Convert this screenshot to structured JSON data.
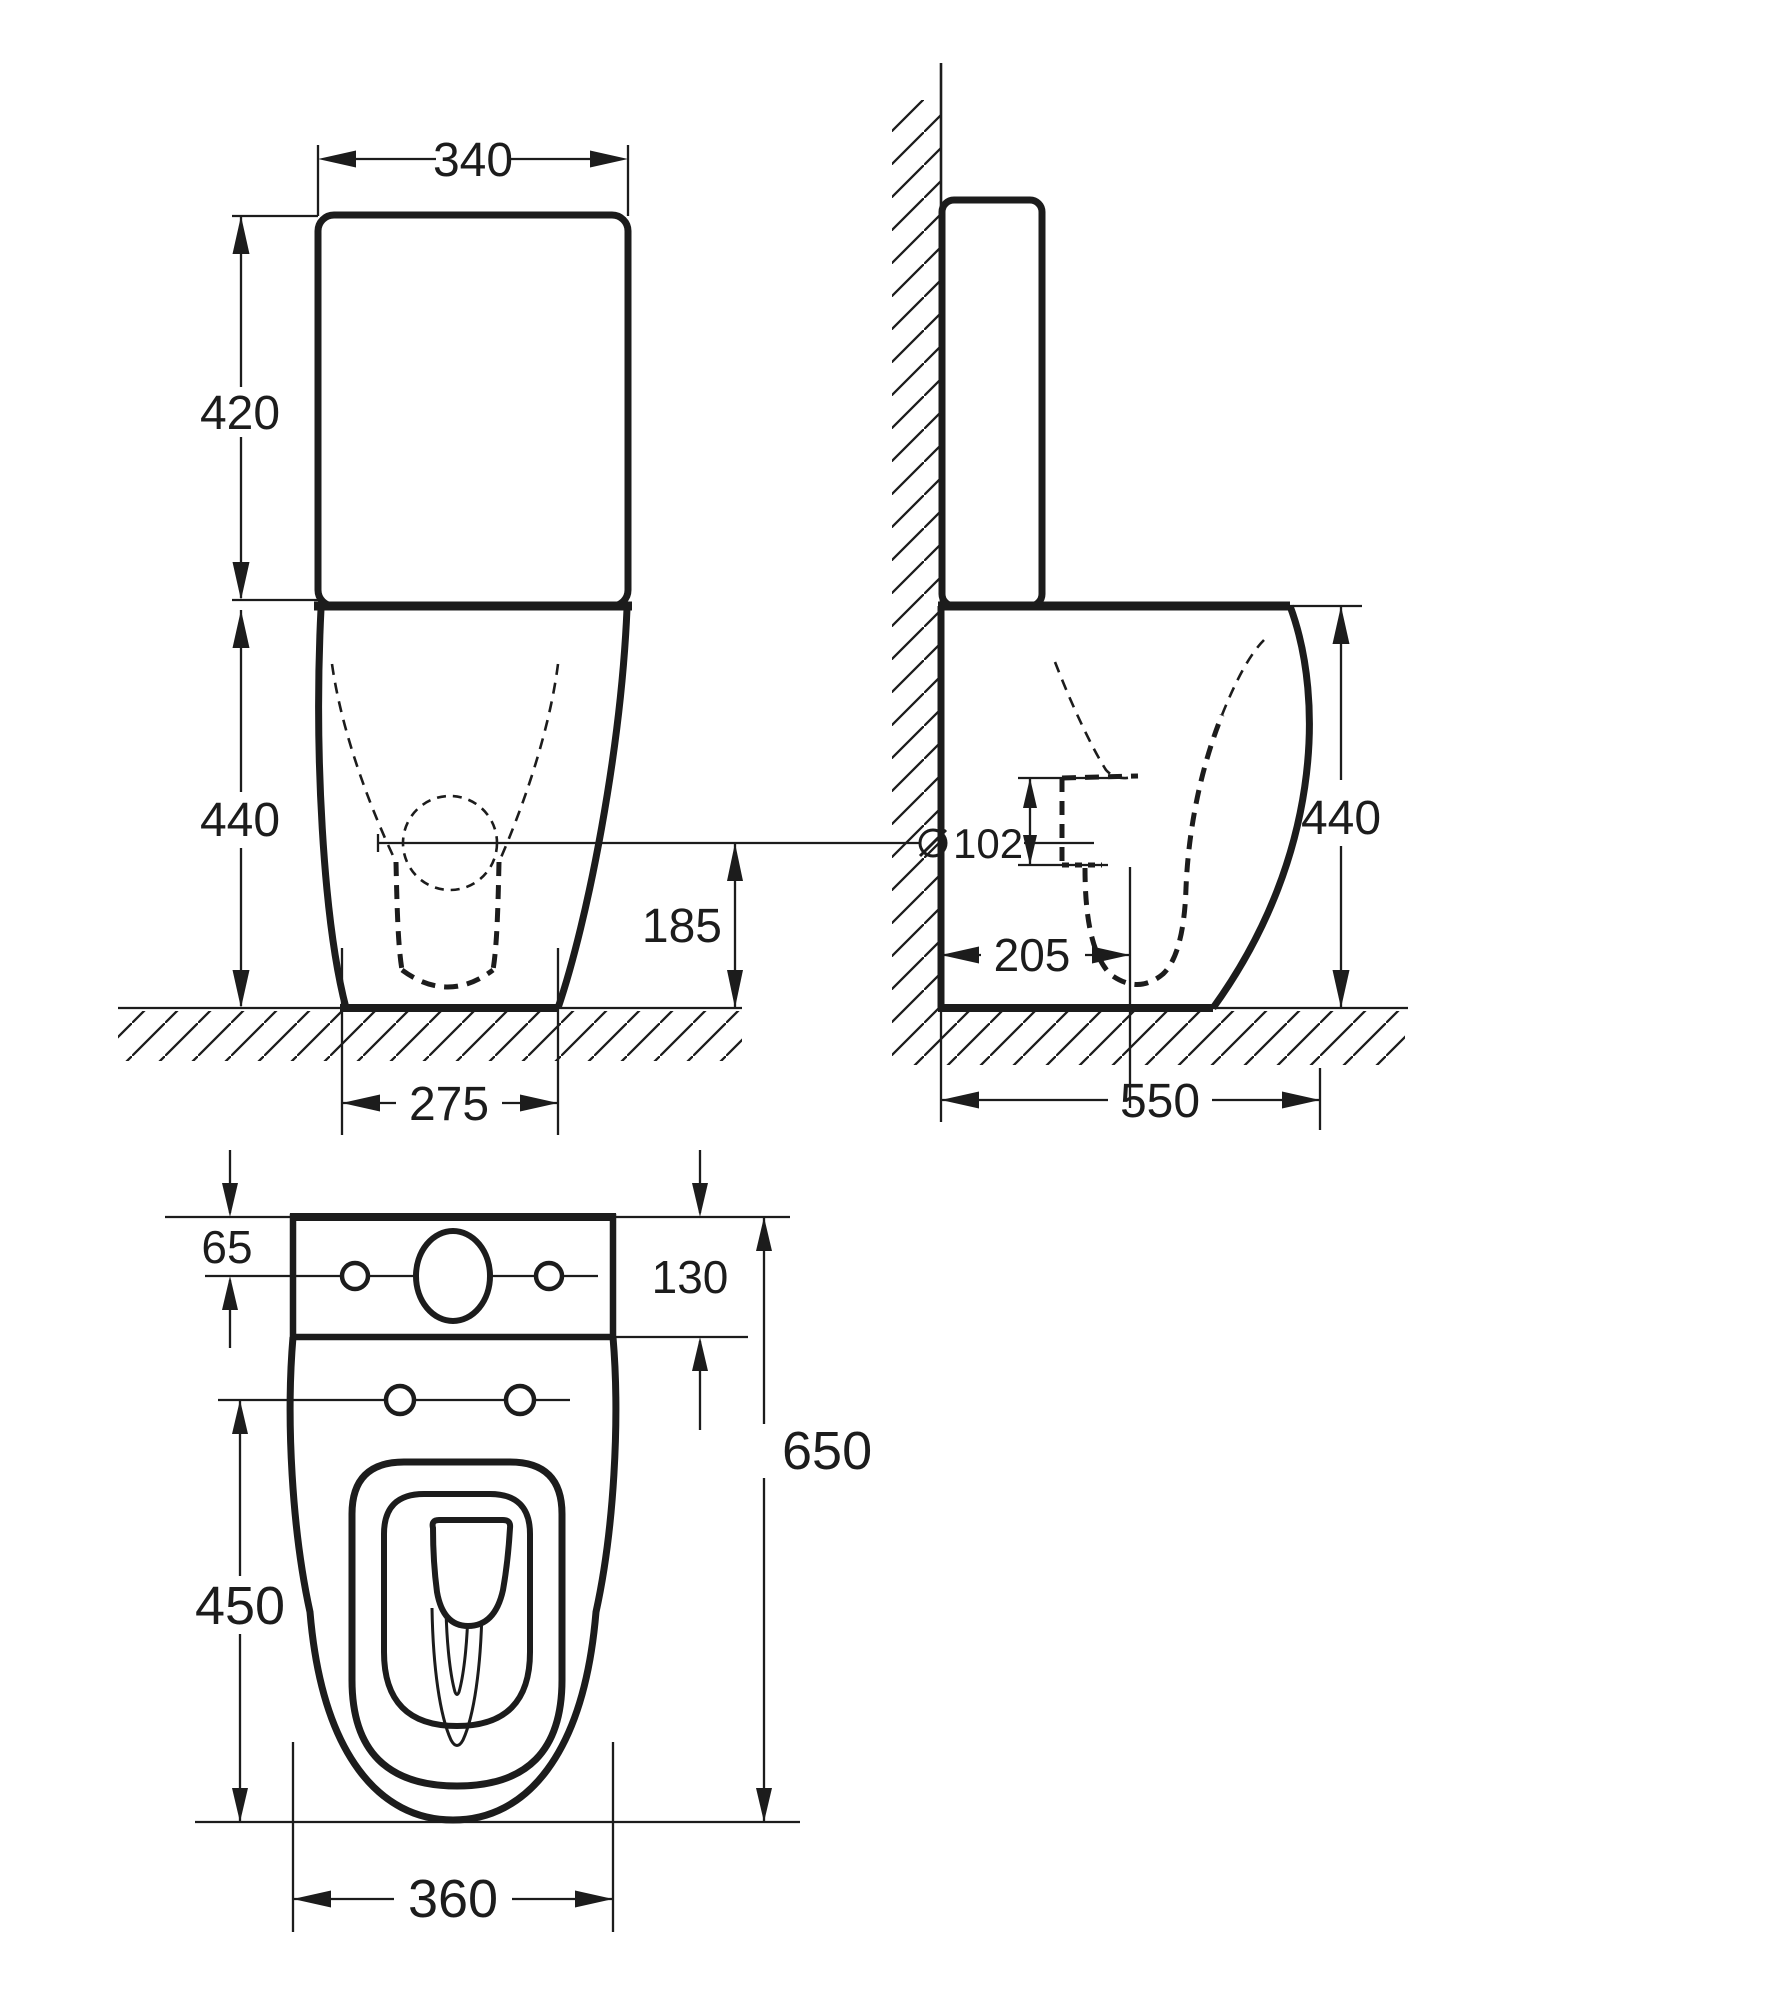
{
  "drawing_title": "Close coupled toilet suite - dimensioned three-view technical drawing",
  "units": "mm",
  "colors": {
    "line": "#1c1c1c",
    "background": "#ffffff"
  },
  "front_view": {
    "overall_width": "340",
    "cistern_height": "420",
    "pan_height": "440",
    "trap_centre_height": "185",
    "base_width": "275"
  },
  "side_view": {
    "outlet_symbol": "⌀",
    "outlet_diameter": "102",
    "outlet_setout": "205",
    "pan_height": "440",
    "overall_depth": "550"
  },
  "top_view": {
    "lid_to_holes": "65",
    "cistern_depth": "130",
    "seat_length": "450",
    "overall_length": "650",
    "overall_width": "360"
  }
}
